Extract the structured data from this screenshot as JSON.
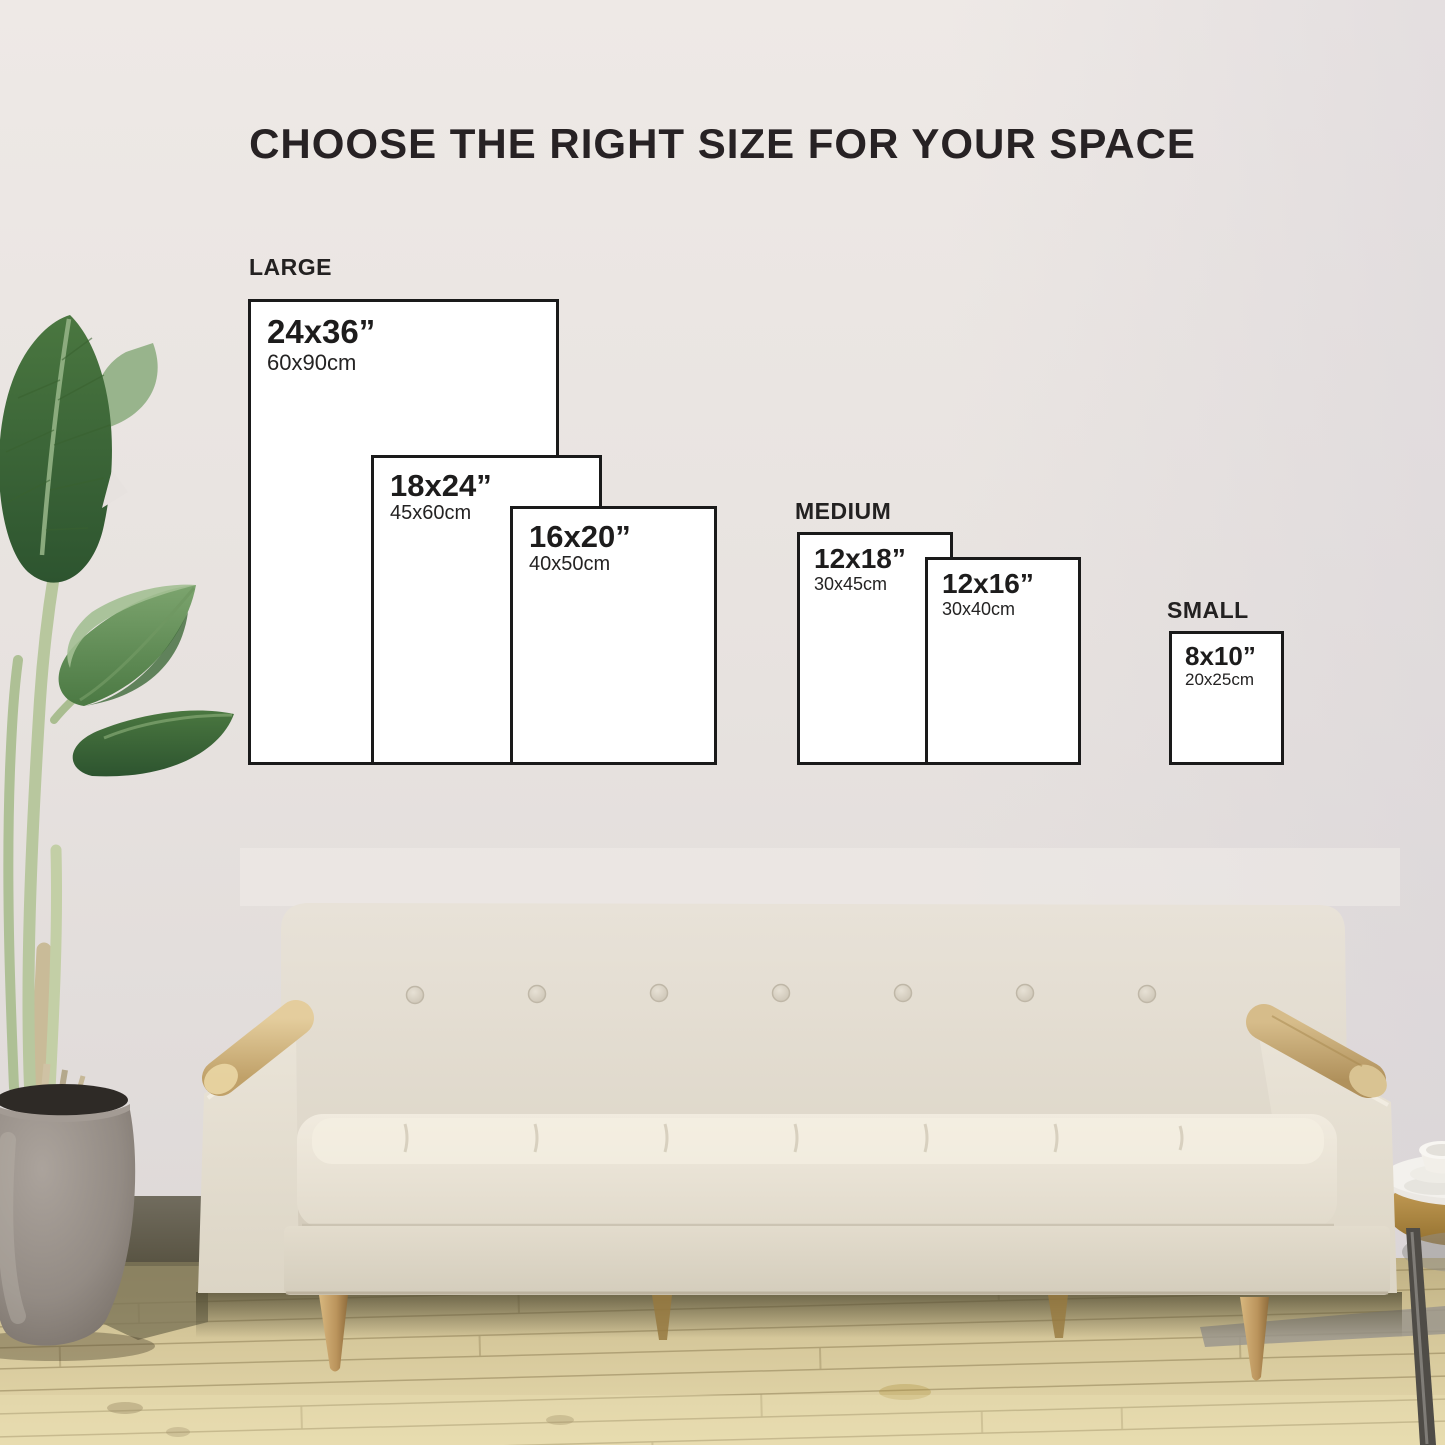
{
  "title": "CHOOSE THE RIGHT SIZE FOR YOUR SPACE",
  "groups": {
    "large": {
      "label": "LARGE"
    },
    "medium": {
      "label": "MEDIUM"
    },
    "small": {
      "label": "SMALL"
    }
  },
  "sizes": [
    {
      "inches": "24x36”",
      "cm": "60x90cm",
      "group": "LARGE"
    },
    {
      "inches": "18x24”",
      "cm": "45x60cm",
      "group": "LARGE"
    },
    {
      "inches": "16x20”",
      "cm": "40x50cm",
      "group": "LARGE"
    },
    {
      "inches": "12x18”",
      "cm": "30x45cm",
      "group": "MEDIUM"
    },
    {
      "inches": "12x16”",
      "cm": "30x40cm",
      "group": "MEDIUM"
    },
    {
      "inches": "8x10”",
      "cm": "20x25cm",
      "group": "SMALL"
    }
  ],
  "colors": {
    "wall": "#e9e4e2",
    "box_fill": "#ffffff",
    "box_border": "#1a1a1a",
    "title_text": "#272224",
    "sofa_fabric": "#e3dccd",
    "arm_wood": "#c9ab74",
    "floor_wood": "#dbcda1",
    "leaf_green": "#3f6a3c",
    "planter_gray": "#8e867f"
  }
}
